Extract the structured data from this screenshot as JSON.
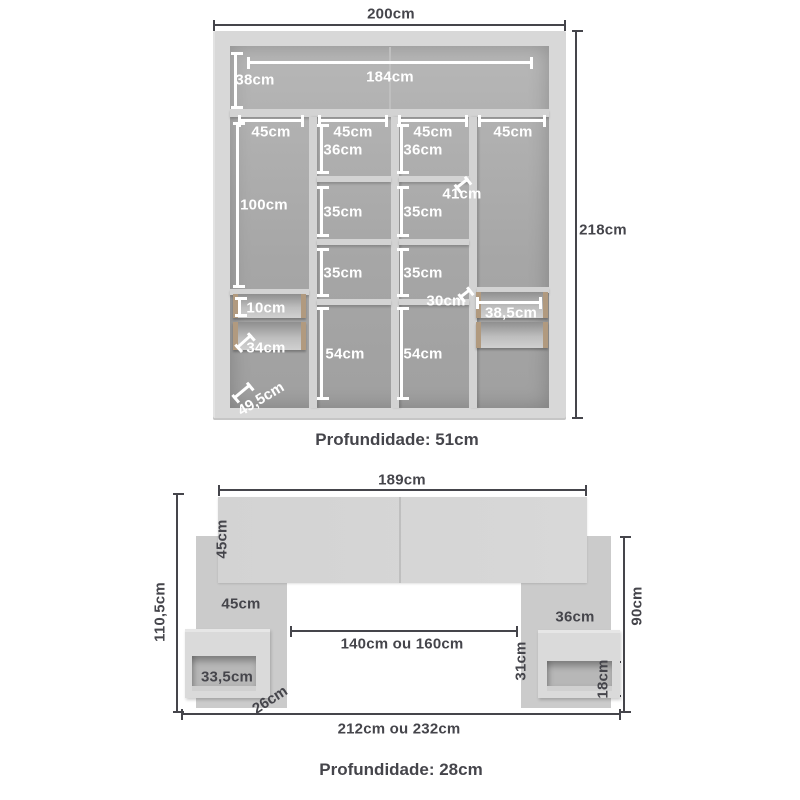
{
  "colors": {
    "ink": "#45454b",
    "wardrobe_frame": "#d8d8d8",
    "wardrobe_interior": "#a8a8a8",
    "shelf": "#d3d3d3",
    "drawer_rail": "#b19a7f",
    "headboard_panel": "#cbcbcb",
    "dim_line_inside": "#ffffff"
  },
  "wardrobe": {
    "overall_width": "200cm",
    "overall_height": "218cm",
    "depth_caption": "Profundidade: 51cm",
    "top_section": {
      "inner_width": "184cm",
      "height": "38cm"
    },
    "column_widths": [
      "45cm",
      "45cm",
      "45cm",
      "45cm"
    ],
    "left_column_height": "100cm",
    "shelves": {
      "row1": [
        "36cm",
        "36cm"
      ],
      "row2": [
        "35cm",
        "35cm"
      ],
      "row3": [
        "35cm",
        "35cm"
      ],
      "row4": [
        "54cm",
        "54cm"
      ]
    },
    "shelf_depth": "41cm",
    "drawer_front_height": "10cm",
    "drawer_depth": "34cm",
    "left_bottom_depth": "49,5cm",
    "drawer_section_height": "30cm",
    "right_drawer_width": "38,5cm"
  },
  "headboard": {
    "panel_width": "189cm",
    "panel_height": "45cm",
    "total_height": "110,5cm",
    "side_panel_width": "45cm",
    "bed_gap": "140cm ou 160cm",
    "total_width": "212cm ou 232cm",
    "right_height": "90cm",
    "nightstand_right_width": "36cm",
    "nightstand_right_height": "31cm",
    "niche_right_height": "18cm",
    "niche_left_width": "33,5cm",
    "nightstand_depth": "26cm",
    "depth_caption": "Profundidade: 28cm"
  }
}
